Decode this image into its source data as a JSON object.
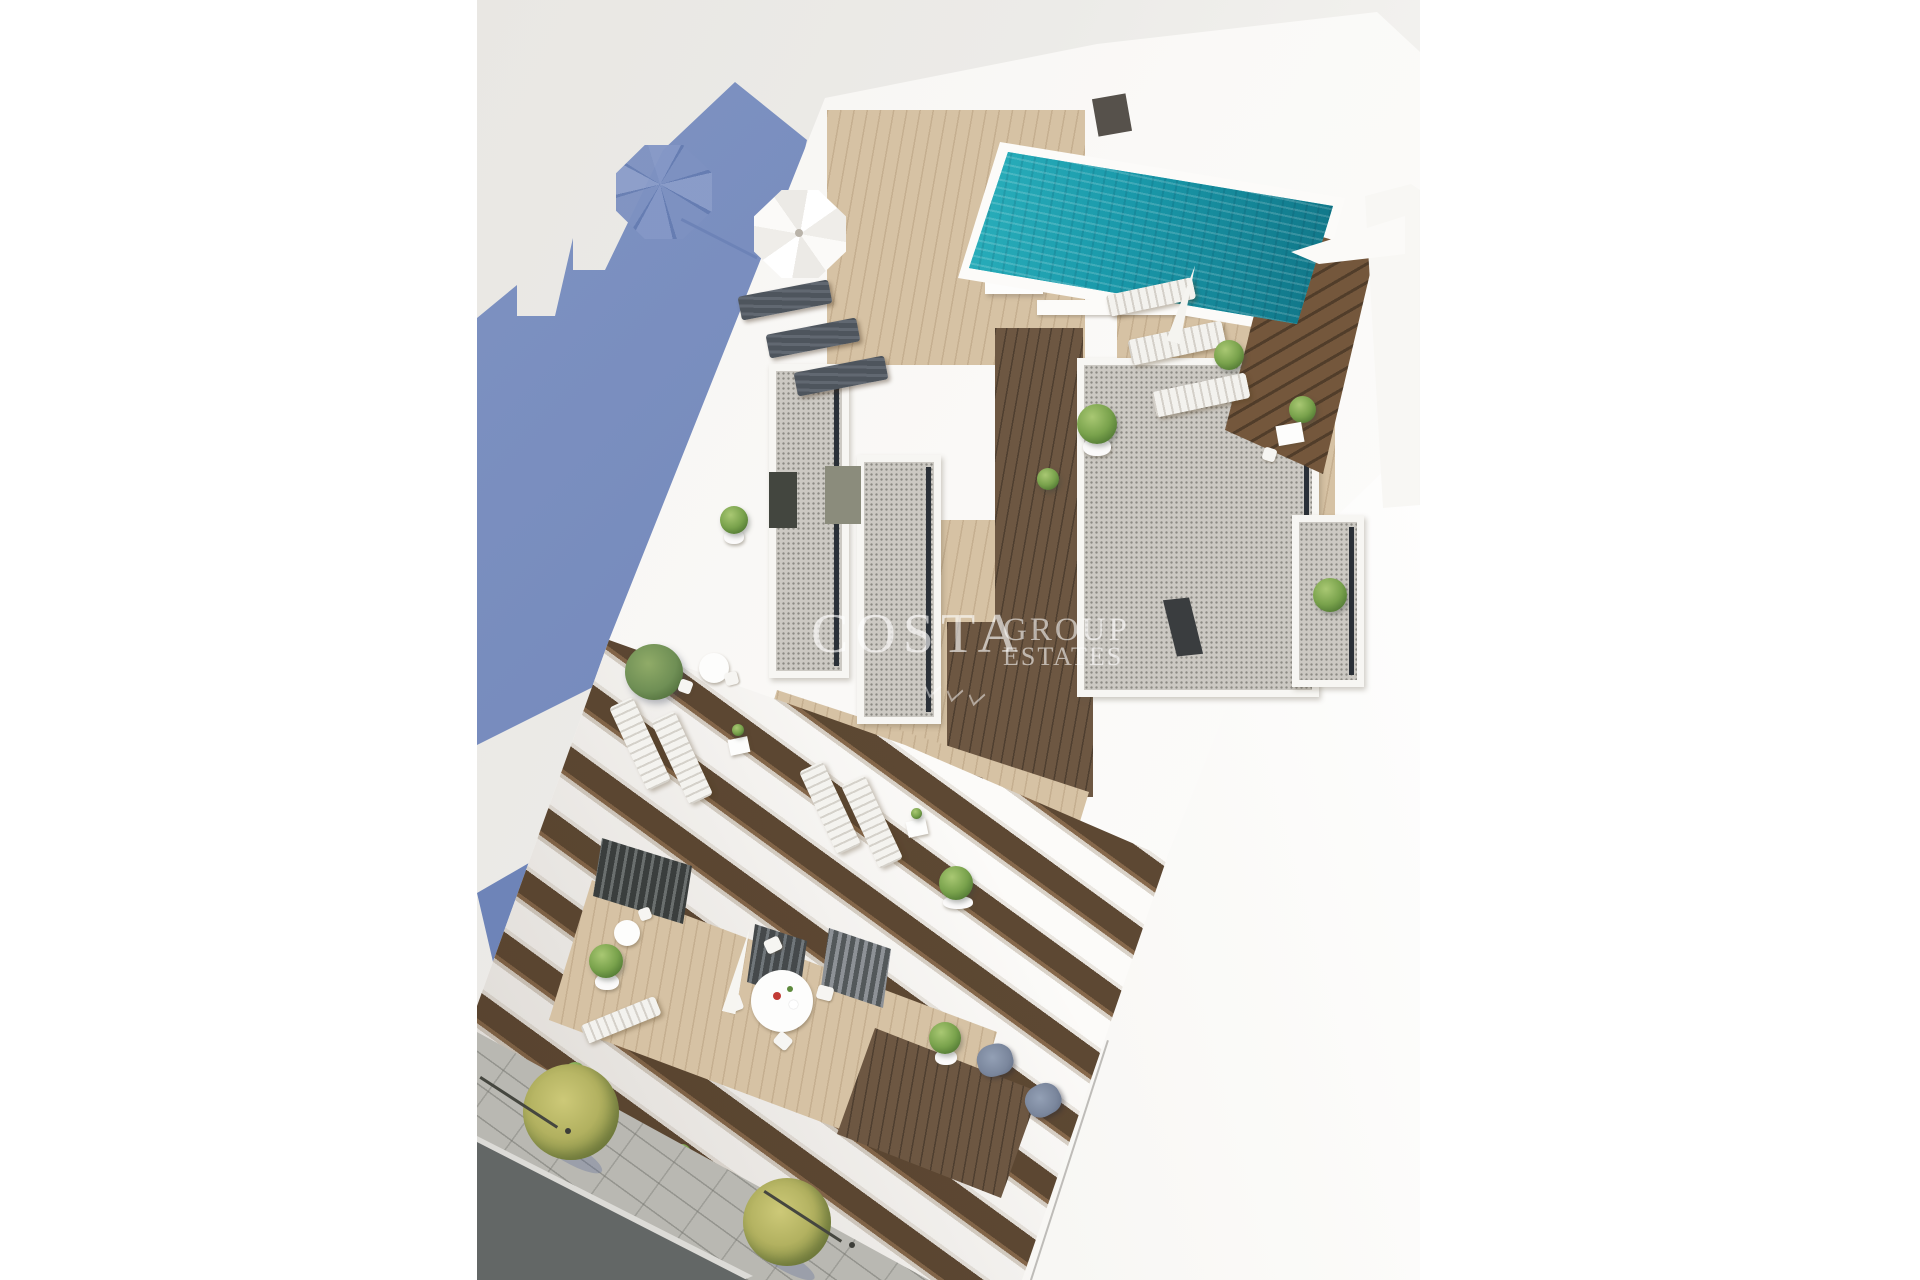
{
  "image": {
    "alt": "Aerial 3D architectural rendering of a white apartment building: rooftop with turquoise swimming pool, wooden sun decks, gravel roof volumes, terraces with sun loungers, umbrellas and plants, stepped balconies descending to a street with trees, and a large slate-blue building shadow cast on the ground."
  },
  "watermark": {
    "primary": "COSTA",
    "secondary": "GROUP",
    "tertiary": "ESTATES"
  },
  "palette": {
    "ground": "#ecebe8",
    "shadow_blue": "#7388bb",
    "shadow_blue_dark": "#6e84b8",
    "building_white": "#faf9f7",
    "wood_light": "#d6c2a4",
    "wood_dark": "#6d5742",
    "gravel": "#ccc9c3",
    "pool_light": "#66d8da",
    "pool_teal": "#2ab6c4",
    "pool_deep": "#0a4e5d",
    "foliage": "#79a24c",
    "street_tree": "#b2b160",
    "asphalt": "#636766",
    "sidewalk": "#b9b8b2",
    "door_olive": "#8b8c7c",
    "armchair_gray": "#7b879d",
    "watermark": "rgba(255,255,255,0.62)"
  }
}
